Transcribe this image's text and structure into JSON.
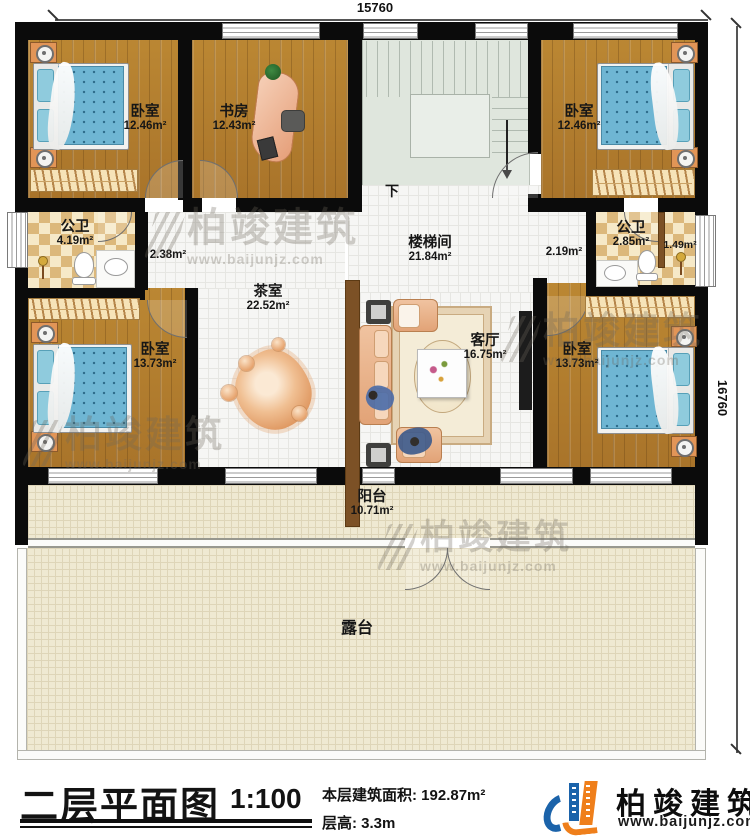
{
  "dimensions": {
    "top": "15760",
    "right": "16760"
  },
  "rooms": {
    "bedroom_tl": {
      "name": "卧室",
      "area": "12.46m²"
    },
    "study": {
      "name": "书房",
      "area": "12.43m²"
    },
    "bedroom_tr": {
      "name": "卧室",
      "area": "12.46m²"
    },
    "bath_left": {
      "name": "公卫",
      "area": "4.19m²"
    },
    "bath_right": {
      "name": "公卫",
      "area": "2.85m²",
      "shower_area": "1.49m²"
    },
    "hall_left_area": "2.38m²",
    "hall_right_area": "2.19m²",
    "stairwell": {
      "name": "楼梯间",
      "area": "21.84m²",
      "down_label": "下"
    },
    "tea_room": {
      "name": "茶室",
      "area": "22.52m²"
    },
    "living_room": {
      "name": "客厅",
      "area": "16.75m²"
    },
    "bedroom_bl": {
      "name": "卧室",
      "area": "13.73m²"
    },
    "bedroom_br": {
      "name": "卧室",
      "area": "13.73m²"
    },
    "balcony": {
      "name": "阳台",
      "area": "10.71m²"
    },
    "terrace": {
      "name": "露台"
    }
  },
  "watermark": {
    "brand": "柏竣建筑",
    "url": "www.baijunjz.com"
  },
  "footer": {
    "title": "二层平面图",
    "scale": "1:100",
    "area_label": "本层建筑面积:",
    "area_value": "192.87m²",
    "floor_height_label": "层高:",
    "floor_height_value": "3.3m",
    "brand": "柏竣建筑",
    "brand_url": "www.baijunjz.com"
  }
}
